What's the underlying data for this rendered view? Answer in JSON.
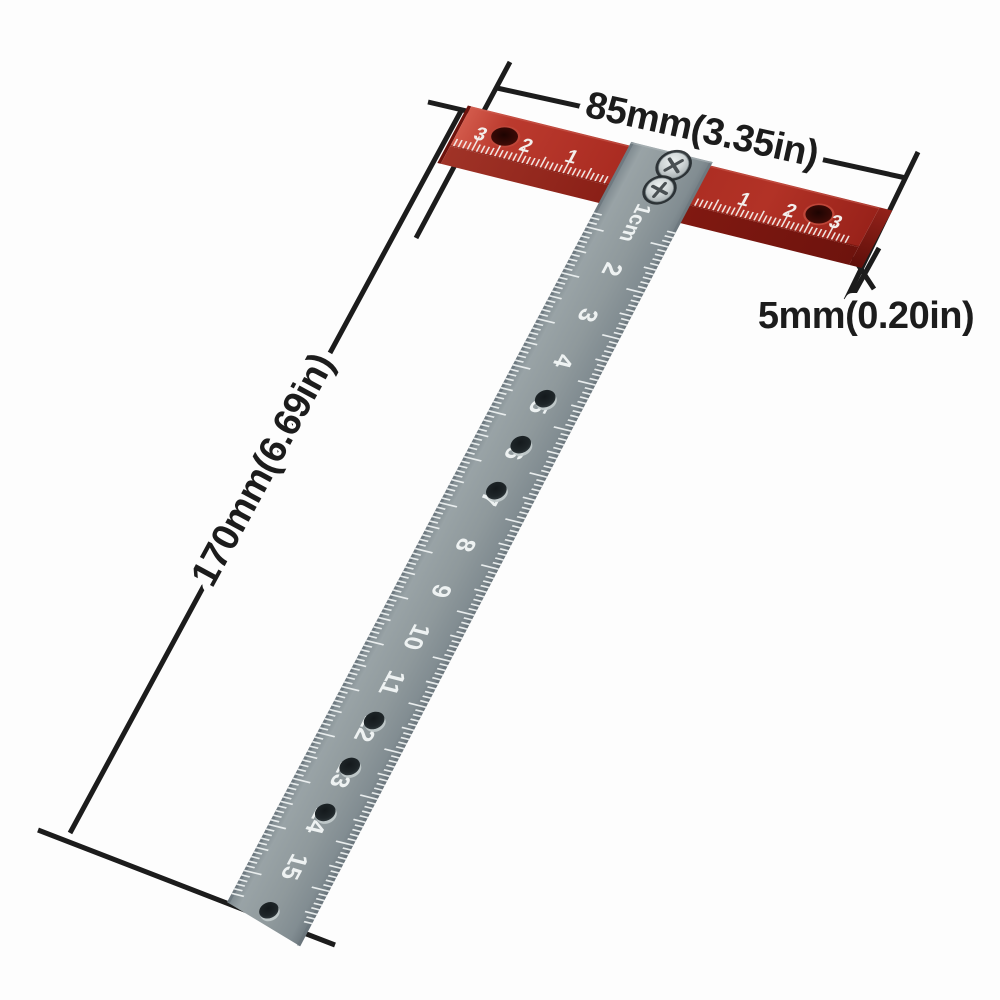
{
  "scene": {
    "background": "#fdfdfd",
    "annotation_color": "#1c1c1c"
  },
  "annotations": {
    "head_width_label": "85mm(3.35in)",
    "blade_length_label": "170mm(6.69in)",
    "head_thickness_label": "5mm(0.20in)"
  },
  "tool": {
    "kind": "t-square-marking-ruler",
    "head": {
      "color_top": "#a82a20",
      "color_front": "#7c170f",
      "tick_color": "#f3efec",
      "numbers_left": [
        "3",
        "2",
        "1"
      ],
      "numbers_right": [
        "1",
        "2",
        "3"
      ],
      "mm_ticks_per_side": 34,
      "hole_count": 2
    },
    "blade": {
      "color": "#8d979b",
      "tick_color": "#eef2f2",
      "numbers": [
        "1cm",
        "2",
        "3",
        "4",
        "5",
        "6",
        "7",
        "8",
        "9",
        "10",
        "11",
        "12",
        "13",
        "14",
        "15"
      ],
      "holes_at_cm": [
        4.5,
        5.5,
        6.5,
        11.5,
        12.5,
        13.5
      ],
      "end_hole_at_cm": 15.65,
      "screw_count": 2
    }
  }
}
